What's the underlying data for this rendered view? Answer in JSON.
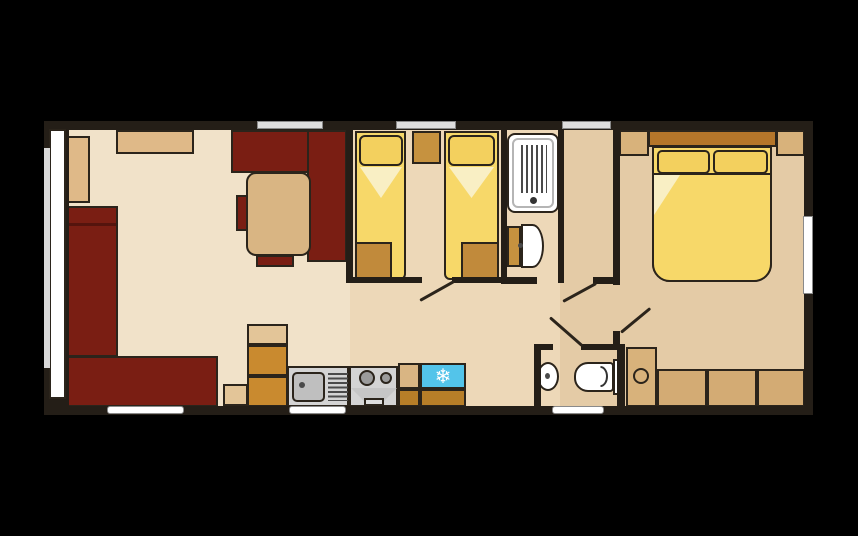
{
  "canvas": {
    "width": 858,
    "height": 536,
    "background": "#000000"
  },
  "palette": {
    "wall": "#241e17",
    "outline": "#2b241b",
    "maroon_sofa": "#7a1e13",
    "floor_lounge": "#f1e2c9",
    "floor_twin": "#edd8b8",
    "floor_hall": "#e4cba6",
    "cushion_tan": "#dfb988",
    "table_tan": "#d9b583",
    "wardrobe_tan": "#d8b27b",
    "gold_unit": "#c18a3b",
    "kitchen_orange": "#c98a2f",
    "kitchen_orange_dark": "#b77e28",
    "bed_yellow": "#f7d869",
    "pillow_yellow": "#f3d05e",
    "duvet_fold": "#f9efc4",
    "headboard_brown": "#b5762a",
    "appliance_gray": "#d4d4d4",
    "fridge_cyan": "#53c4ea",
    "window_fill": "#dedede",
    "window_stroke": "#8a8a8a",
    "white": "#ffffff"
  },
  "rooms": [
    "lounge-diner",
    "kitchen",
    "twin-bedroom",
    "shower-room",
    "wc-washroom",
    "hallway",
    "double-bedroom"
  ],
  "icons": [
    {
      "name": "fridge-snowflake-icon",
      "glyph": "❄"
    }
  ],
  "shapes": [
    {
      "name": "lounge-floor",
      "kind": "rect",
      "x": 49,
      "y": 129,
      "w": 301,
      "h": 277,
      "fill": "#f1e2c9",
      "floor": true
    },
    {
      "name": "twin-room-floor",
      "kind": "rect",
      "x": 350,
      "y": 129,
      "w": 214,
      "h": 277,
      "fill": "#edd8b8",
      "floor": true
    },
    {
      "name": "hall-bedroom-floor",
      "kind": "rect",
      "x": 560,
      "y": 129,
      "w": 246,
      "h": 277,
      "fill": "#e4cba6",
      "floor": true
    },
    {
      "name": "lounge-seat-cushion-left",
      "kind": "rect",
      "x": 66,
      "y": 136,
      "w": 24,
      "h": 67,
      "fill": "#dfb988",
      "stroke": true
    },
    {
      "name": "lounge-seat-cushion-top",
      "kind": "rect",
      "x": 116,
      "y": 130,
      "w": 78,
      "h": 24,
      "fill": "#dfb988",
      "stroke": true
    },
    {
      "name": "sofa-left-section",
      "kind": "rect",
      "x": 66,
      "y": 206,
      "w": 52,
      "h": 151,
      "fill": "#7a1e13",
      "stroke": true
    },
    {
      "name": "sofa-left-armrest-line",
      "kind": "rect",
      "x": 68,
      "y": 223,
      "w": 48,
      "h": 3,
      "fill": "rgba(0,0,0,0.30)"
    },
    {
      "name": "sofa-bottom-section",
      "kind": "rect",
      "x": 61,
      "y": 356,
      "w": 157,
      "h": 51,
      "fill": "#7a1e13",
      "stroke": true
    },
    {
      "name": "dining-bench-top",
      "kind": "rect",
      "x": 231,
      "y": 130,
      "w": 92,
      "h": 43,
      "fill": "#7a1e13",
      "stroke": true
    },
    {
      "name": "dining-bench-right",
      "kind": "rect",
      "x": 307,
      "y": 130,
      "w": 40,
      "h": 132,
      "fill": "#7a1e13",
      "stroke": true
    },
    {
      "name": "dining-table",
      "kind": "rect",
      "x": 246,
      "y": 172,
      "w": 65,
      "h": 84,
      "fill": "#d9b583",
      "stroke": true,
      "r": "10px"
    },
    {
      "name": "dining-chair-left",
      "kind": "rect",
      "x": 236,
      "y": 195,
      "w": 12,
      "h": 36,
      "fill": "#7a1e13",
      "stroke": true
    },
    {
      "name": "dining-chair-bottom",
      "kind": "rect",
      "x": 256,
      "y": 255,
      "w": 38,
      "h": 12,
      "fill": "#7a1e13",
      "stroke": true
    },
    {
      "name": "side-table-block",
      "kind": "rect",
      "x": 223,
      "y": 384,
      "w": 25,
      "h": 22,
      "fill": "#e3c598",
      "stroke": true
    },
    {
      "name": "kitchen-tall-unit-top",
      "kind": "rect",
      "x": 247,
      "y": 324,
      "w": 41,
      "h": 21,
      "fill": "#e3c598",
      "stroke": true
    },
    {
      "name": "kitchen-tall-unit-mid",
      "kind": "rect",
      "x": 247,
      "y": 345,
      "w": 41,
      "h": 31,
      "fill": "#c98a2f",
      "stroke": true
    },
    {
      "name": "kitchen-tall-unit-bottom",
      "kind": "rect",
      "x": 247,
      "y": 376,
      "w": 41,
      "h": 31,
      "fill": "#c98a2f",
      "stroke": true
    },
    {
      "name": "sink-unit",
      "kind": "rect",
      "x": 287,
      "y": 366,
      "w": 62,
      "h": 41,
      "fill": "#d4d4d4",
      "stroke": true
    },
    {
      "name": "sink-bowl",
      "kind": "rect",
      "x": 292,
      "y": 372,
      "w": 33,
      "h": 30,
      "fill": "#bfbfbf",
      "stroke": true,
      "r": "5px"
    },
    {
      "name": "sink-faucet-dot",
      "kind": "rect",
      "x": 299,
      "y": 382,
      "w": 6,
      "h": 6,
      "fill": "#4a4a4a",
      "r": "50%"
    },
    {
      "name": "sink-drainer-lines",
      "kind": "rect",
      "x": 328,
      "y": 373,
      "w": 20,
      "h": 28,
      "pattern": "h"
    },
    {
      "name": "cooker-unit",
      "kind": "rect",
      "x": 349,
      "y": 366,
      "w": 49,
      "h": 41,
      "fill": "#d4d4d4",
      "stroke": true
    },
    {
      "name": "cooker-burner-large",
      "kind": "rect",
      "x": 359,
      "y": 370,
      "w": 16,
      "h": 16,
      "fill": "#9b9b9b",
      "stroke": true,
      "r": "50%"
    },
    {
      "name": "cooker-burner-small",
      "kind": "rect",
      "x": 380,
      "y": 372,
      "w": 12,
      "h": 12,
      "fill": "#9b9b9b",
      "stroke": true,
      "r": "50%"
    },
    {
      "name": "oven-front-trapezoid",
      "kind": "rect",
      "x": 351,
      "y": 388,
      "w": 46,
      "h": 13,
      "fill": "#c6c6c6",
      "clip": "polygon(0% 0%, 100% 0%, 72% 100%, 28% 100%)"
    },
    {
      "name": "oven-door",
      "kind": "rect",
      "x": 364,
      "y": 398,
      "w": 20,
      "h": 8,
      "fill": "#dedede",
      "stroke": true
    },
    {
      "name": "worktop-piece",
      "kind": "rect",
      "x": 398,
      "y": 363,
      "w": 22,
      "h": 26,
      "fill": "#d9b583",
      "stroke": true
    },
    {
      "name": "worktop-under-cabinet",
      "kind": "rect",
      "x": 398,
      "y": 389,
      "w": 22,
      "h": 18,
      "fill": "#b77e28",
      "stroke": true
    },
    {
      "name": "fridge",
      "kind": "glyph",
      "x": 420,
      "y": 363,
      "w": 46,
      "h": 26,
      "fill": "#53c4ea",
      "stroke": true,
      "glyph": "❄",
      "size": 20
    },
    {
      "name": "fridge-under-cabinet",
      "kind": "rect",
      "x": 420,
      "y": 389,
      "w": 46,
      "h": 18,
      "fill": "#b77e28",
      "stroke": true
    },
    {
      "name": "twin-bed-left",
      "kind": "rect",
      "x": 355,
      "y": 131,
      "w": 51,
      "h": 149,
      "fill": "#f7d869",
      "stroke": true,
      "r": "0 0 6px 6px"
    },
    {
      "name": "twin-bed-left-pillow",
      "kind": "rect",
      "x": 359,
      "y": 135,
      "w": 44,
      "h": 31,
      "fill": "#f3d05e",
      "stroke": true,
      "r": "6px"
    },
    {
      "name": "twin-bed-left-duvet-fold",
      "kind": "rect",
      "x": 360,
      "y": 167,
      "w": 42,
      "h": 31,
      "fill": "#f9efc4",
      "clip": "polygon(0% 0%, 100% 0%, 50% 100%)"
    },
    {
      "name": "twin-bed-left-foot-locker",
      "kind": "rect",
      "x": 355,
      "y": 242,
      "w": 37,
      "h": 38,
      "fill": "#c18a3b",
      "stroke": true
    },
    {
      "name": "bedside-cabinet",
      "kind": "rect",
      "x": 412,
      "y": 131,
      "w": 29,
      "h": 33,
      "fill": "#c6923f",
      "stroke": true
    },
    {
      "name": "twin-bed-right",
      "kind": "rect",
      "x": 444,
      "y": 131,
      "w": 55,
      "h": 149,
      "fill": "#f7d869",
      "stroke": true,
      "r": "0 0 6px 6px"
    },
    {
      "name": "twin-bed-right-pillow",
      "kind": "rect",
      "x": 448,
      "y": 135,
      "w": 47,
      "h": 31,
      "fill": "#f3d05e",
      "stroke": true,
      "r": "6px"
    },
    {
      "name": "twin-bed-right-duvet-fold",
      "kind": "rect",
      "x": 449,
      "y": 167,
      "w": 45,
      "h": 31,
      "fill": "#f9efc4",
      "clip": "polygon(0% 0%, 100% 0%, 50% 100%)"
    },
    {
      "name": "twin-bed-right-foot-locker",
      "kind": "rect",
      "x": 461,
      "y": 242,
      "w": 38,
      "h": 38,
      "fill": "#c18a3b",
      "stroke": true
    },
    {
      "name": "shower-tray",
      "kind": "rect",
      "x": 507,
      "y": 133,
      "w": 52,
      "h": 80,
      "fill": "#ffffff",
      "stroke": true,
      "r": "8px"
    },
    {
      "name": "shower-tray-inner",
      "kind": "ring",
      "x": 512,
      "y": 138,
      "w": 42,
      "h": 70,
      "bcolor": "#b5b5b5",
      "r": "6px"
    },
    {
      "name": "shower-drain-lines",
      "kind": "rect",
      "x": 521,
      "y": 145,
      "w": 26,
      "h": 48,
      "pattern": "v"
    },
    {
      "name": "shower-drain-dot",
      "kind": "rect",
      "x": 530,
      "y": 197,
      "w": 7,
      "h": 7,
      "fill": "#333333",
      "r": "50%"
    },
    {
      "name": "shower-wc-cistern",
      "kind": "rect",
      "x": 507,
      "y": 226,
      "w": 14,
      "h": 41,
      "fill": "#c6923f",
      "stroke": true
    },
    {
      "name": "shower-wc-bowl",
      "kind": "rect",
      "x": 521,
      "y": 224,
      "w": 23,
      "h": 44,
      "fill": "#ffffff",
      "stroke": true,
      "r": "0 50% 50% 0"
    },
    {
      "name": "shower-wc-dot",
      "kind": "rect",
      "x": 518,
      "y": 243,
      "w": 5,
      "h": 5,
      "fill": "#4a4a4a",
      "r": "50%"
    },
    {
      "name": "wc-basin",
      "kind": "rect",
      "x": 537,
      "y": 362,
      "w": 22,
      "h": 29,
      "fill": "#ffffff",
      "stroke": true,
      "r": "50%"
    },
    {
      "name": "wc-basin-dot",
      "kind": "rect",
      "x": 545,
      "y": 373,
      "w": 5,
      "h": 6,
      "fill": "#4a4a4a",
      "r": "50%"
    },
    {
      "name": "wc-toilet-bowl",
      "kind": "rect",
      "x": 574,
      "y": 362,
      "w": 40,
      "h": 30,
      "fill": "#ffffff",
      "stroke": true,
      "r": "14px 4px 4px 14px"
    },
    {
      "name": "wc-toilet-seat-arc",
      "kind": "ring",
      "x": 593,
      "y": 366,
      "w": 15,
      "h": 21,
      "bcolor": "#333333",
      "r": "50%",
      "clip": "inset(-2px -2px -2px 50%)"
    },
    {
      "name": "wc-toilet-cistern",
      "kind": "rect",
      "x": 613,
      "y": 359,
      "w": 10,
      "h": 36,
      "fill": "#ffffff",
      "stroke": true
    },
    {
      "name": "wardrobe-left",
      "kind": "rect",
      "x": 619,
      "y": 130,
      "w": 30,
      "h": 26,
      "fill": "#d8b27b",
      "stroke": true
    },
    {
      "name": "double-bed-headboard",
      "kind": "rect",
      "x": 648,
      "y": 130,
      "w": 129,
      "h": 17,
      "fill": "#b5762a",
      "stroke": true
    },
    {
      "name": "wardrobe-right",
      "kind": "rect",
      "x": 776,
      "y": 130,
      "w": 29,
      "h": 26,
      "fill": "#d8b27b",
      "stroke": true
    },
    {
      "name": "double-bed",
      "kind": "rect",
      "x": 652,
      "y": 146,
      "w": 120,
      "h": 136,
      "fill": "#f7d869",
      "stroke": true,
      "r": "0 0 18px 18px"
    },
    {
      "name": "double-bed-pillow-left",
      "kind": "rect",
      "x": 657,
      "y": 150,
      "w": 53,
      "h": 24,
      "fill": "#f3d05e",
      "stroke": true,
      "r": "5px"
    },
    {
      "name": "double-bed-pillow-right",
      "kind": "rect",
      "x": 713,
      "y": 150,
      "w": 55,
      "h": 24,
      "fill": "#f3d05e",
      "stroke": true,
      "r": "5px"
    },
    {
      "name": "double-bed-duvet",
      "kind": "rect",
      "x": 652,
      "y": 173,
      "w": 120,
      "h": 109,
      "fill": "#f7d869",
      "bstyle": "2px solid #2b241b",
      "r": "0 0 18px 18px"
    },
    {
      "name": "double-bed-duvet-fold",
      "kind": "rect",
      "x": 654,
      "y": 175,
      "w": 26,
      "h": 40,
      "fill": "#f9efc4",
      "clip": "polygon(0% 0%, 100% 0%, 0% 100%)"
    },
    {
      "name": "vanity-cabinet",
      "kind": "rect",
      "x": 626,
      "y": 347,
      "w": 31,
      "h": 60,
      "fill": "#d8b27b",
      "stroke": true
    },
    {
      "name": "vanity-cabinet-knob",
      "kind": "ring",
      "x": 633,
      "y": 368,
      "w": 16,
      "h": 16,
      "bcolor": "#2b241b",
      "r": "50%"
    },
    {
      "name": "bedroom-drawer-1",
      "kind": "rect",
      "x": 657,
      "y": 369,
      "w": 50,
      "h": 38,
      "fill": "#d3ab74",
      "stroke": true
    },
    {
      "name": "bedroom-drawer-2",
      "kind": "rect",
      "x": 707,
      "y": 369,
      "w": 50,
      "h": 38,
      "fill": "#d3ab74",
      "stroke": true
    },
    {
      "name": "bedroom-drawer-3",
      "kind": "rect",
      "x": 757,
      "y": 369,
      "w": 48,
      "h": 38,
      "fill": "#d3ab74",
      "stroke": true
    },
    {
      "name": "wall-top",
      "kind": "rect",
      "x": 44,
      "y": 121,
      "w": 769,
      "h": 9,
      "fill": "#241e17"
    },
    {
      "name": "wall-bottom",
      "kind": "rect",
      "x": 44,
      "y": 406,
      "w": 769,
      "h": 9,
      "fill": "#241e17"
    },
    {
      "name": "wall-left",
      "kind": "rect",
      "x": 44,
      "y": 121,
      "w": 25,
      "h": 294,
      "fill": "#241e17"
    },
    {
      "name": "wall-right",
      "kind": "rect",
      "x": 804,
      "y": 121,
      "w": 9,
      "h": 294,
      "fill": "#241e17"
    },
    {
      "name": "wall-lounge-twin",
      "kind": "rect",
      "x": 346,
      "y": 129,
      "w": 7,
      "h": 154,
      "fill": "#241e17"
    },
    {
      "name": "wall-twin-shower",
      "kind": "rect",
      "x": 501,
      "y": 129,
      "w": 6,
      "h": 154,
      "fill": "#241e17"
    },
    {
      "name": "wall-shower-hall",
      "kind": "rect",
      "x": 558,
      "y": 129,
      "w": 6,
      "h": 154,
      "fill": "#241e17"
    },
    {
      "name": "wall-bedroom-left-upper",
      "kind": "rect",
      "x": 613,
      "y": 129,
      "w": 7,
      "h": 156,
      "fill": "#241e17"
    },
    {
      "name": "wall-twin-bottom-left",
      "kind": "rect",
      "x": 346,
      "y": 277,
      "w": 76,
      "h": 6,
      "fill": "#241e17"
    },
    {
      "name": "wall-twin-bottom-right",
      "kind": "rect",
      "x": 452,
      "y": 277,
      "w": 55,
      "h": 6,
      "fill": "#241e17"
    },
    {
      "name": "wall-shower-bottom",
      "kind": "rect",
      "x": 501,
      "y": 277,
      "w": 36,
      "h": 7,
      "fill": "#241e17"
    },
    {
      "name": "wall-bedroom-door-stub",
      "kind": "rect",
      "x": 593,
      "y": 277,
      "w": 27,
      "h": 7,
      "fill": "#241e17"
    },
    {
      "name": "wall-bedroom-stub-lower",
      "kind": "rect",
      "x": 613,
      "y": 331,
      "w": 7,
      "h": 17,
      "fill": "#241e17"
    },
    {
      "name": "wall-wc-left",
      "kind": "rect",
      "x": 534,
      "y": 344,
      "w": 7,
      "h": 63,
      "fill": "#241e17"
    },
    {
      "name": "wall-wc-top-left",
      "kind": "rect",
      "x": 534,
      "y": 344,
      "w": 19,
      "h": 6,
      "fill": "#241e17"
    },
    {
      "name": "wall-wc-top-right",
      "kind": "rect",
      "x": 581,
      "y": 344,
      "w": 44,
      "h": 6,
      "fill": "#241e17"
    },
    {
      "name": "wall-wc-right",
      "kind": "rect",
      "x": 617,
      "y": 344,
      "w": 8,
      "h": 63,
      "fill": "#241e17"
    },
    {
      "name": "window-top-lounge",
      "kind": "rect",
      "x": 257,
      "y": 121,
      "w": 66,
      "h": 8,
      "fill": "#dedede",
      "bstyle": "1px solid #8a8a8a"
    },
    {
      "name": "window-top-twin",
      "kind": "rect",
      "x": 396,
      "y": 121,
      "w": 60,
      "h": 8,
      "fill": "#dedede",
      "bstyle": "1px solid #8a8a8a"
    },
    {
      "name": "window-top-hall",
      "kind": "rect",
      "x": 562,
      "y": 121,
      "w": 49,
      "h": 8,
      "fill": "#dedede",
      "bstyle": "1px solid #8a8a8a"
    },
    {
      "name": "window-bottom-lounge",
      "kind": "rect",
      "x": 107,
      "y": 406,
      "w": 77,
      "h": 8,
      "fill": "#ffffff",
      "bstyle": "1px solid #8a8a8a",
      "r": "3px"
    },
    {
      "name": "window-bottom-kitchen",
      "kind": "rect",
      "x": 289,
      "y": 406,
      "w": 57,
      "h": 8,
      "fill": "#ffffff",
      "bstyle": "1px solid #8a8a8a",
      "r": "3px"
    },
    {
      "name": "window-bottom-wc",
      "kind": "rect",
      "x": 552,
      "y": 406,
      "w": 52,
      "h": 8,
      "fill": "#ffffff",
      "bstyle": "1px solid #8a8a8a",
      "r": "3px"
    },
    {
      "name": "front-door-glazing",
      "kind": "rect",
      "x": 49,
      "y": 129,
      "w": 17,
      "h": 270,
      "fill": "#ffffff",
      "stroke": true
    },
    {
      "name": "front-door-outer-rail",
      "kind": "rect",
      "x": 44,
      "y": 148,
      "w": 6,
      "h": 220,
      "fill": "#d9d9d9"
    },
    {
      "name": "window-right-bedroom",
      "kind": "rect",
      "x": 803,
      "y": 216,
      "w": 10,
      "h": 78,
      "fill": "#ffffff",
      "bstyle": "1px solid #8a8a8a"
    },
    {
      "name": "door-leaf-twin-bedroom",
      "kind": "line",
      "x": 420,
      "y": 299,
      "len": 39,
      "rot": -29.2
    },
    {
      "name": "door-leaf-bedroom-corridor",
      "kind": "line",
      "x": 563,
      "y": 300,
      "len": 38,
      "rot": -28.6
    },
    {
      "name": "door-leaf-wc",
      "kind": "line",
      "x": 550,
      "y": 316,
      "len": 43,
      "rot": 41.2
    },
    {
      "name": "door-leaf-double-bedroom",
      "kind": "line",
      "x": 621,
      "y": 331,
      "len": 38,
      "rot": -39.6
    }
  ]
}
